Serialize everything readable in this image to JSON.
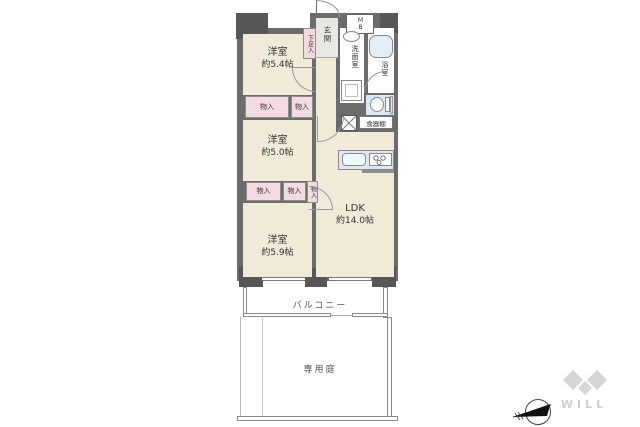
{
  "rooms": {
    "yoshitsu_a": {
      "name": "洋室",
      "size": "約5.4帖"
    },
    "yoshitsu_b": {
      "name": "洋室",
      "size": "約5.0帖"
    },
    "yoshitsu_c": {
      "name": "洋室",
      "size": "約5.9帖"
    },
    "ldk": {
      "name": "LDK",
      "size": "約14.0帖"
    }
  },
  "labels": {
    "entrance": "玄関",
    "shoe_box": "下足入",
    "meter_box": "MB",
    "washroom": "洗面室",
    "bathroom": "浴室",
    "storage": "物入",
    "cupboard": "食器棚",
    "balcony": "バルコニー",
    "private_garden": "専用庭"
  },
  "brand": {
    "name": "WILL"
  },
  "colors": {
    "wall": "#6c6c6c",
    "pillar": "#575757",
    "floor": "#f1ead9",
    "closet_pink": "#f4dbe2",
    "water_blue": "#dbe7f3",
    "outline_gray": "#8d8d8d",
    "logo_gray": "#d6d6d6"
  }
}
